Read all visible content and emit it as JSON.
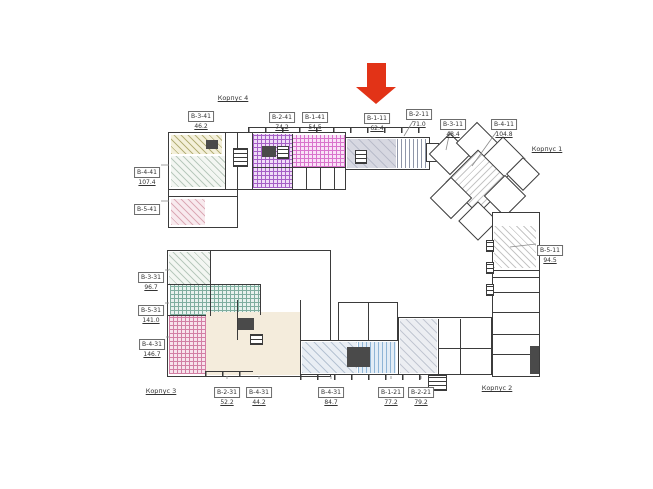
{
  "page": {
    "background": "#ffffff"
  },
  "selection_arrow": {
    "points_to_unit": "В-1-11"
  },
  "korpus_labels": [
    {
      "text": "Корпус 4",
      "x": 233,
      "y": 94
    },
    {
      "text": "Корпус 1",
      "x": 547,
      "y": 145
    },
    {
      "text": "Корпус 2",
      "x": 497,
      "y": 384
    },
    {
      "text": "Корпус 3",
      "x": 161,
      "y": 387
    }
  ],
  "units": [
    {
      "code": "В-3-41",
      "area": "46.2",
      "x": 201,
      "y": 103
    },
    {
      "code": "В-2-41",
      "area": "74.2",
      "x": 282,
      "y": 104
    },
    {
      "code": "В-1-41",
      "area": "54.5",
      "x": 315,
      "y": 104
    },
    {
      "code": "В-1-11",
      "area": "62.4",
      "x": 377,
      "y": 105,
      "selected": true
    },
    {
      "code": "В-2-11",
      "area": "71.0",
      "x": 419,
      "y": 101,
      "leader": [
        413,
        121,
        404,
        136
      ]
    },
    {
      "code": "В-3-11",
      "area": "48.4",
      "x": 453,
      "y": 111,
      "leader": [
        450,
        131,
        446,
        150
      ]
    },
    {
      "code": "В-4-11",
      "area": "104.8",
      "x": 504,
      "y": 111,
      "leader": [
        497,
        131,
        472,
        166
      ]
    },
    {
      "code": "В-4-41",
      "area": "107.4",
      "x": 147,
      "y": 159,
      "leader": [
        161,
        165,
        169,
        165
      ]
    },
    {
      "code": "В-5-41",
      "area": "",
      "x": 147,
      "y": 196,
      "leader": [
        161,
        201,
        169,
        201
      ]
    },
    {
      "code": "В-5-11",
      "area": "94.5",
      "x": 550,
      "y": 237,
      "leader": [
        536,
        244,
        510,
        247
      ]
    },
    {
      "code": "В-3-31",
      "area": "96.7",
      "x": 151,
      "y": 264,
      "leader": [
        165,
        270,
        169,
        270
      ]
    },
    {
      "code": "В-5-31",
      "area": "141.0",
      "x": 151,
      "y": 297,
      "leader": [
        165,
        303,
        169,
        303
      ]
    },
    {
      "code": "В-4-31",
      "area": "146.7",
      "x": 152,
      "y": 331,
      "leader": [
        166,
        337,
        169,
        337
      ]
    },
    {
      "code": "В-2-31",
      "area": "52.2",
      "x": 227,
      "y": 379,
      "leader": [
        227,
        379,
        227,
        376
      ]
    },
    {
      "code": "В-4-31",
      "area": "44.2",
      "x": 259,
      "y": 379,
      "leader": [
        259,
        379,
        259,
        376
      ]
    },
    {
      "code": "В-4-31",
      "area": "84.7",
      "x": 331,
      "y": 379,
      "leader": [
        331,
        379,
        331,
        376
      ]
    },
    {
      "code": "В-1-21",
      "area": "77.2",
      "x": 391,
      "y": 379,
      "leader": [
        391,
        379,
        391,
        376
      ]
    },
    {
      "code": "В-2-21",
      "area": "79.2",
      "x": 421,
      "y": 379,
      "leader": [
        421,
        379,
        421,
        376
      ]
    }
  ],
  "colors": {
    "wall": "#3b3b3b",
    "dark": "#4a4a4a",
    "arrow": "#e23317",
    "leader": "#8a8a8a",
    "olive_ln": "#b5b078",
    "olive_bg": "#f4f0da",
    "green_ln": "#b9c9bd",
    "green_bg": "#f3f6f2",
    "pinkd_ln": "#dcaab6",
    "pinkd_bg": "#f8eaee",
    "violet_ln": "#a55fc6",
    "violet_bg": "#efdcf7",
    "magenta_ln": "#d973cc",
    "magenta_bg": "#f9e2f7",
    "grayu_ln": "#b9bcca",
    "grayu_bg": "#d7d8e1",
    "vstr_ln": "#8f96a8",
    "teald_ln": "#abd2c8",
    "teald_bg": "#daeee8",
    "tealg_ln": "#7fae9f",
    "tealg_bg": "#e8f2ee",
    "pinkg_ln": "#d27fa4",
    "pinkg_bg": "#f7e3ec",
    "beige_bg": "#f4ecdc",
    "bgray_ln": "#b6c3d3",
    "bgray_bg": "#e9eef4",
    "bstr_ln": "#8fb5d6",
    "bstr_bg": "#e3edf6",
    "gdiag_ln": "#c2c7d2",
    "gdiag_bg": "#eceef2",
    "rstrip_ln": "#c6c6c6"
  }
}
